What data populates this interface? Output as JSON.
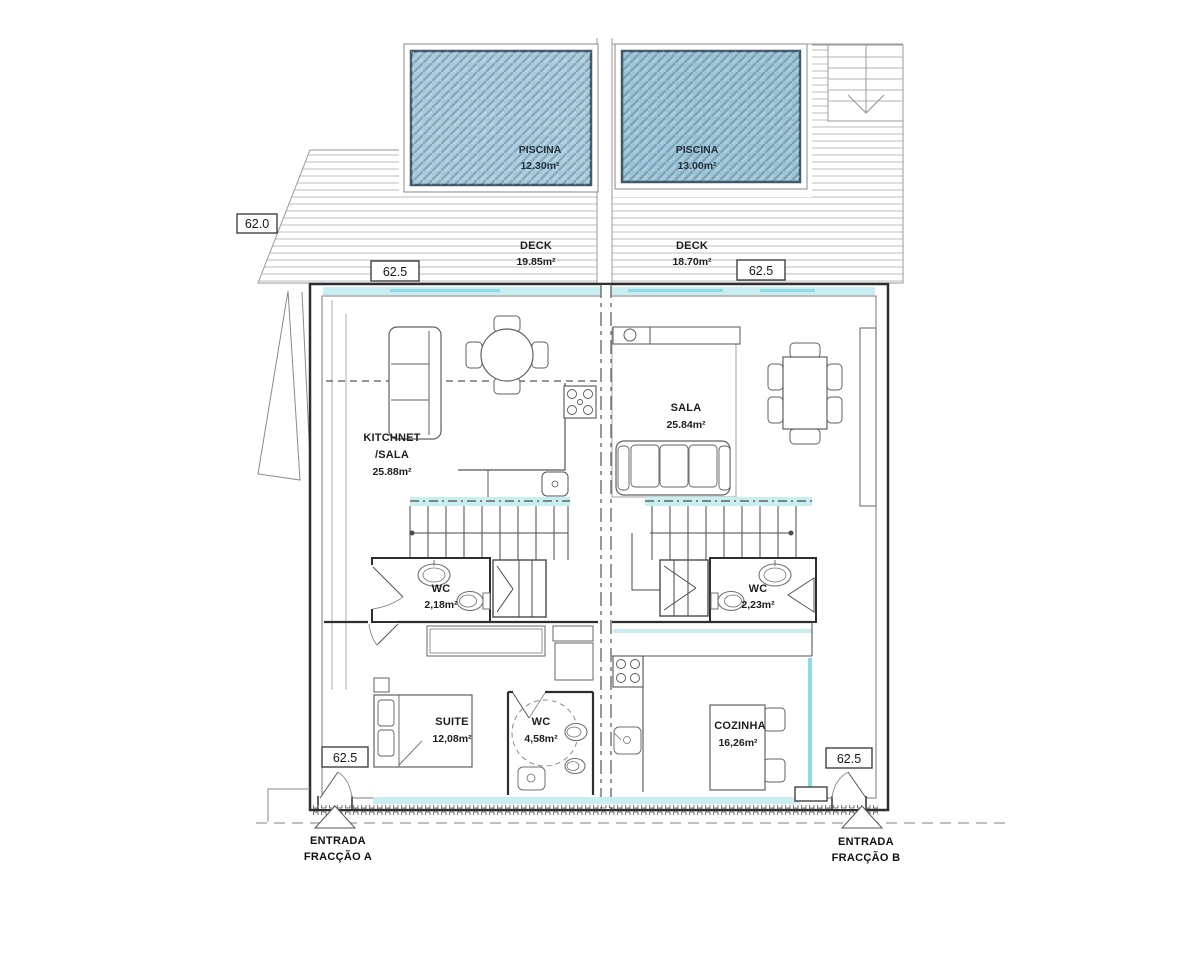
{
  "drawing": {
    "pools": {
      "a": {
        "name": "PISCINA",
        "area": "12.30m²"
      },
      "b": {
        "name": "PISCINA",
        "area": "13.00m²"
      }
    },
    "decks": {
      "a": {
        "name": "DECK",
        "area": "19.85m²"
      },
      "b": {
        "name": "DECK",
        "area": "18.70m²"
      }
    },
    "rooms": {
      "kitchnet": {
        "line1": "KITCHNET",
        "line2": "/SALA",
        "area": "25.88m²"
      },
      "sala": {
        "name": "SALA",
        "area": "25.84m²"
      },
      "wc_a": {
        "name": "WC",
        "area": "2,18m²"
      },
      "wc_b": {
        "name": "WC",
        "area": "2,23m²"
      },
      "suite": {
        "name": "SUITE",
        "area": "12,08m²"
      },
      "suite_wc": {
        "name": "WC",
        "area": "4,58m²"
      },
      "cozinha": {
        "name": "COZINHA",
        "area": "16,26m²"
      }
    },
    "levels": {
      "lower_deck": "62.0",
      "deck_a": "62.5",
      "deck_b": "62.5",
      "entry_a": "62.5",
      "entry_b": "62.5"
    },
    "entrances": {
      "a": {
        "line1": "ENTRADA",
        "line2": "FRACÇÃO A"
      },
      "b": {
        "line1": "ENTRADA",
        "line2": "FRACÇÃO B"
      }
    }
  },
  "colors": {
    "pool_a_fill": "#aacbdc",
    "pool_b_fill": "#9cc3d6",
    "pool_border": "#44596a",
    "glass": "#c9eef2",
    "glass_dark": "#8fdbe3",
    "wall": "#2e2e2e",
    "deck_line": "#bcbcbc",
    "label": "#1e1e1e"
  }
}
